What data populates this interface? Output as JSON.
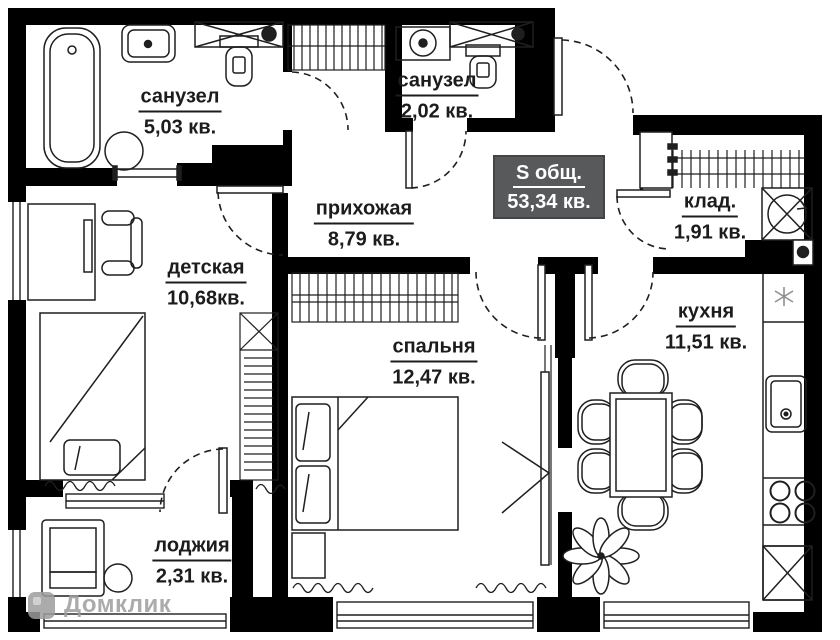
{
  "plan": {
    "title_badge": {
      "label": "S общ.",
      "value": "53,34 кв."
    },
    "rooms": {
      "bathroom_1": {
        "name": "санузел",
        "area": "5,03 кв."
      },
      "bathroom_2": {
        "name": "санузел",
        "area": "2,02 кв."
      },
      "hallway": {
        "name": "прихожая",
        "area": "8,79 кв."
      },
      "storage": {
        "name": "клад.",
        "area": "1,91 кв."
      },
      "kids_room": {
        "name": "детская",
        "area": "10,68кв."
      },
      "bedroom": {
        "name": "спальня",
        "area": "12,47 кв."
      },
      "kitchen": {
        "name": "кухня",
        "area": "11,51 кв."
      },
      "loggia": {
        "name": "лоджия",
        "area": "2,31 кв."
      }
    },
    "watermark": "Домклик",
    "colors": {
      "walls": "#000000",
      "lines": "#1f1f1f",
      "badge_bg": "#58595b",
      "badge_text": "#ffffff",
      "label_text": "#1c1c1c",
      "background": "#ffffff"
    }
  }
}
